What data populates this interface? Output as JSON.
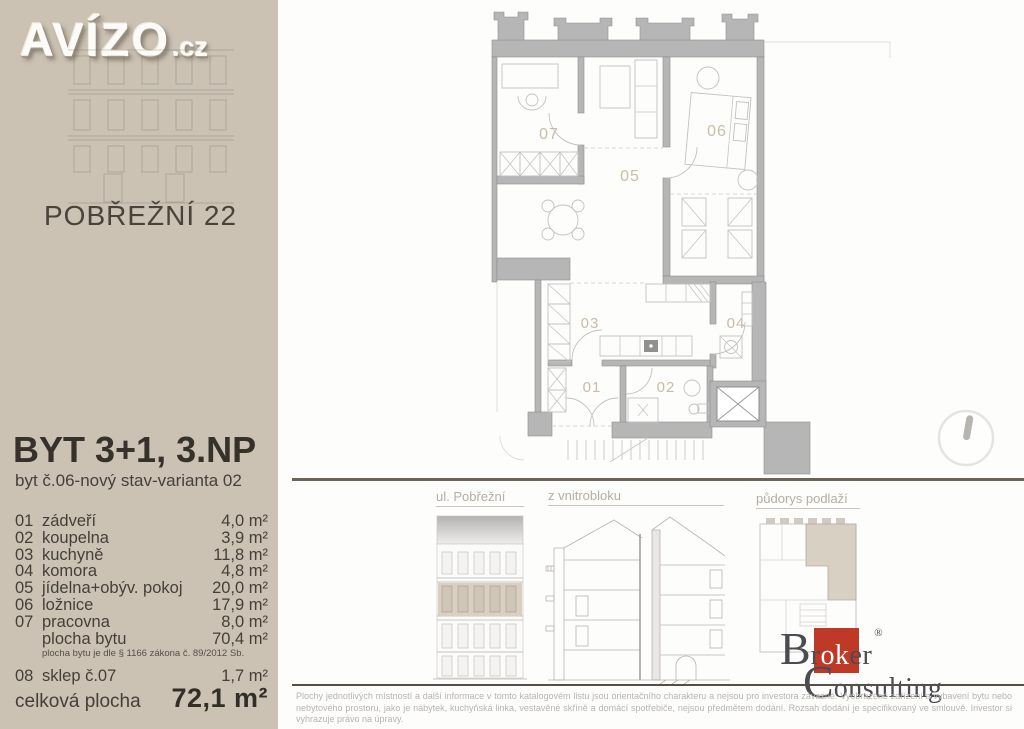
{
  "branding": {
    "logo_text": "AVÍZO",
    "logo_suffix": ".cz"
  },
  "sidebar": {
    "street": "POBŘEŽNÍ 22",
    "flat_title": "BYT 3+1, 3.NP",
    "flat_subtitle": "byt č.06-nový stav-varianta 02",
    "rooms": [
      {
        "no": "01",
        "name": "zádveří",
        "area": "4,0 m²"
      },
      {
        "no": "02",
        "name": "koupelna",
        "area": "3,9 m²"
      },
      {
        "no": "03",
        "name": "kuchyně",
        "area": "11,8 m²"
      },
      {
        "no": "04",
        "name": "komora",
        "area": "4,8 m²"
      },
      {
        "no": "05",
        "name": "jídelna+obýv. pokoj",
        "area": "20,0 m²"
      },
      {
        "no": "06",
        "name": "ložnice",
        "area": "17,9 m²"
      },
      {
        "no": "07",
        "name": "pracovna",
        "area": "8,0 m²"
      }
    ],
    "floor_area": {
      "label": "plocha bytu",
      "area": "70,4 m²"
    },
    "floor_area_note": "plocha bytu je dle § 1166 zákona č. 89/2012 Sb.",
    "cellar": {
      "no": "08",
      "name": "sklep č.07",
      "area": "1,7 m²"
    },
    "total": {
      "label": "celková plocha",
      "area": "72,1 m²"
    }
  },
  "floorplan": {
    "labels": {
      "r01": "01",
      "r02": "02",
      "r03": "03",
      "r04": "04",
      "r05": "05",
      "r06": "06",
      "r07": "07"
    }
  },
  "elevations": {
    "street_label": "ul. Pobřežní",
    "courtyard_label": "z vnitrobloku",
    "floorplan_label": "půdorys podlaží"
  },
  "footer": {
    "broker": {
      "b": "B",
      "r": "r",
      "ok": "ok",
      "er": "er",
      "reg": "®",
      "c": "C",
      "onsulting": "onsulting"
    },
    "disclaimer": "Plochy jednotlivých místností a další informace v tomto katalogovém listu jsou orientačního charakteru a nejsou pro investora závazné. Vyobrazené zařízení a vybavení bytu nebo nebytového prostoru, jako je nábytek, kuchyňská linka, vestavěné skříně a domácí spotřebiče, nejsou předmětem dodání. Rozsah dodání je specifikovaný ve smlouvě. Investor si vyhrazuje právo na úpravy."
  },
  "colors": {
    "sidebar_bg": "#cbc2b4",
    "accent_red": "#bf3927",
    "wall_gray": "#b6b6b6",
    "room_label": "#c9bda8",
    "highlight_beige": "#d8d0c2",
    "divider": "#6b6459",
    "text_dark": "#36312a"
  }
}
